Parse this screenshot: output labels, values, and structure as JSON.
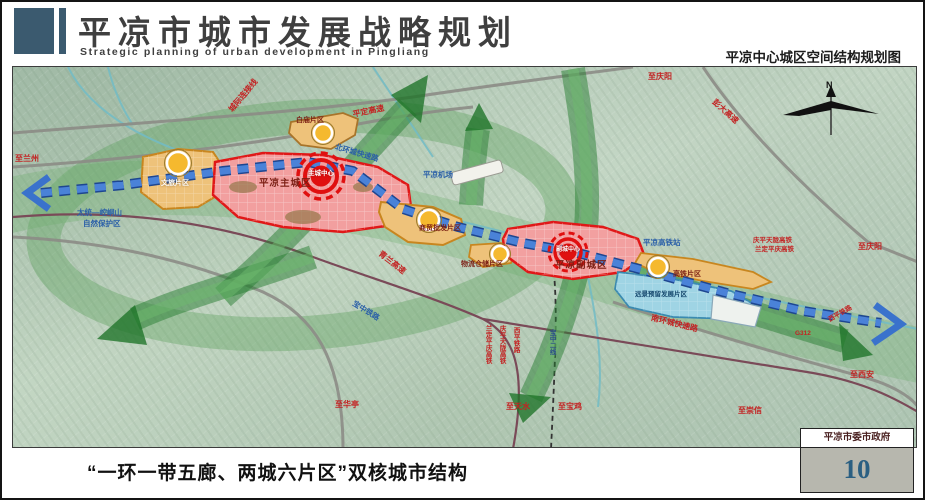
{
  "header": {
    "title": "平凉市城市发展战略规划",
    "title_en": "Strategic planning of urban development in Pingliang",
    "right_subtitle": "平凉中心城区空间结构规划图"
  },
  "footer": {
    "caption": "“一环一带五廊、两城六片区”双核城市结构",
    "organization": "平凉市委市政府",
    "page_number": "10"
  },
  "map": {
    "compass": "N",
    "zones": {
      "wenlv": "文旅片区",
      "baimiao": "白庙片区",
      "main_city": "平凉主城区",
      "sub_city": "平凉副城区",
      "shangmao": "商贸批发片区",
      "wuliu": "物流仓储片区",
      "gaotie": "高铁片区",
      "yuanjing": "远景预留发展片区"
    },
    "cores": {
      "main": "主城中心",
      "sub": "副城中心"
    },
    "labels": {
      "to_lanzhou": "至兰州",
      "to_qingyang_top": "至庆阳",
      "to_qingyang_right": "至庆阳",
      "to_xian": "至西安",
      "to_huating": "至华亭",
      "to_tianshui": "至天水",
      "to_baoji": "至宝鸡",
      "to_chongxin": "至崇信",
      "pengda_expressway": "彭大高速",
      "pingding_expressway": "平定高速",
      "qinglan_expressway": "青兰高速",
      "intercity_link": "城际连接线",
      "north_ring_road": "北环城快速路",
      "south_ring_road": "南环城快速路",
      "g312": "G312",
      "airport": "平凉机场",
      "hsr_station": "平凉高铁站",
      "nature_reserve_line1": "太统—崆峒山",
      "nature_reserve_line2": "自然保护区",
      "hsr_pair_line1": "庆平天陇高铁",
      "hsr_pair_line2": "兰定平庆高铁",
      "v_rail_landing": "兰定平庆高铁",
      "v_rail_qingping": "庆平天陇高铁",
      "v_rail_xiping": "西平铁路",
      "v_rail_baozhong2": "宝中二线",
      "xiping_rail_diag": "西平铁路",
      "baozhong_rail": "宝中铁路"
    },
    "colors": {
      "axis_blue": "#3a72cc",
      "corridor_green": "#2e7d32",
      "core_red": "#e01010",
      "zone_orange": "#eec27a",
      "zone_pink": "#f2a0a0",
      "zone_blue": "#9fd4e4",
      "node_gold": "#f5b92e"
    }
  }
}
